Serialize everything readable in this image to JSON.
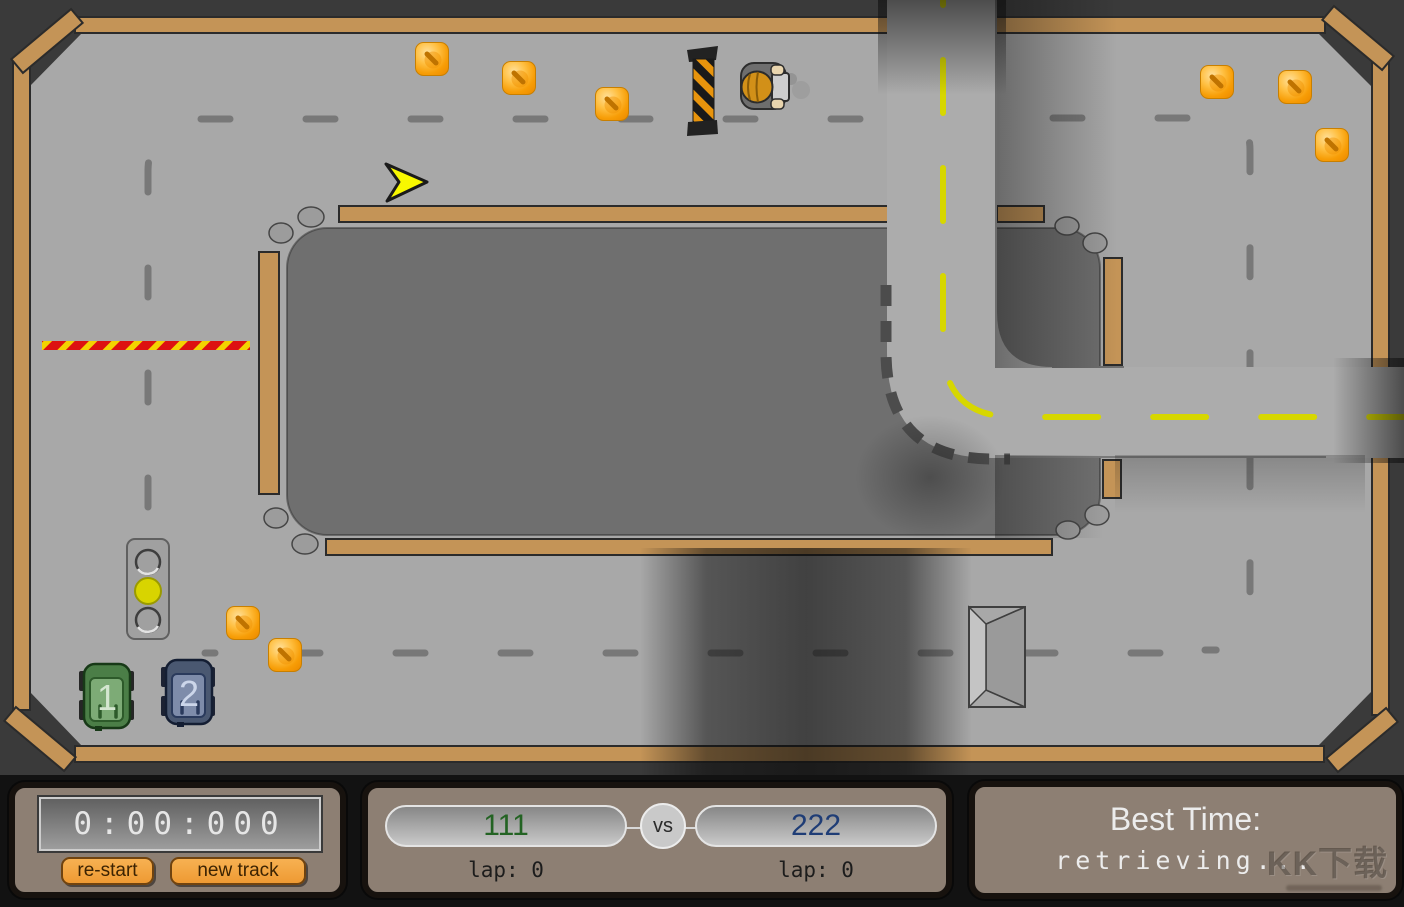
{
  "hud": {
    "timer": "0:00:000",
    "buttons": {
      "restart": "re-start",
      "new_track": "new track"
    },
    "match": {
      "player1_name": "111",
      "player2_name": "222",
      "vs": "vs",
      "player1_lap": "lap: 0",
      "player2_lap": "lap: 0"
    },
    "best": {
      "label": "Best Time:",
      "value": "retrieving..."
    }
  },
  "watermark": "KK下载",
  "game": {
    "car1_number": "1",
    "car2_number": "2",
    "traffic_light_state": "yellow",
    "gems": [
      [
        432,
        59
      ],
      [
        519,
        78
      ],
      [
        612,
        104
      ],
      [
        1217,
        82
      ],
      [
        1295,
        87
      ],
      [
        1332,
        145
      ],
      [
        243,
        623
      ],
      [
        285,
        655
      ]
    ],
    "colors": {
      "field": "#a8a8a8",
      "island": "#6f6f6f",
      "wall": "#c49457",
      "road": "#acacac",
      "road_center_line": "#d7d700",
      "gem": "#f79d06",
      "car1_body": "#4b7e47",
      "car2_body": "#4a5871",
      "button_accent": "#ee9a33",
      "player1_text": "#236323",
      "player2_text": "#1f3d76",
      "traffic_light_on": "#d8d400"
    }
  }
}
